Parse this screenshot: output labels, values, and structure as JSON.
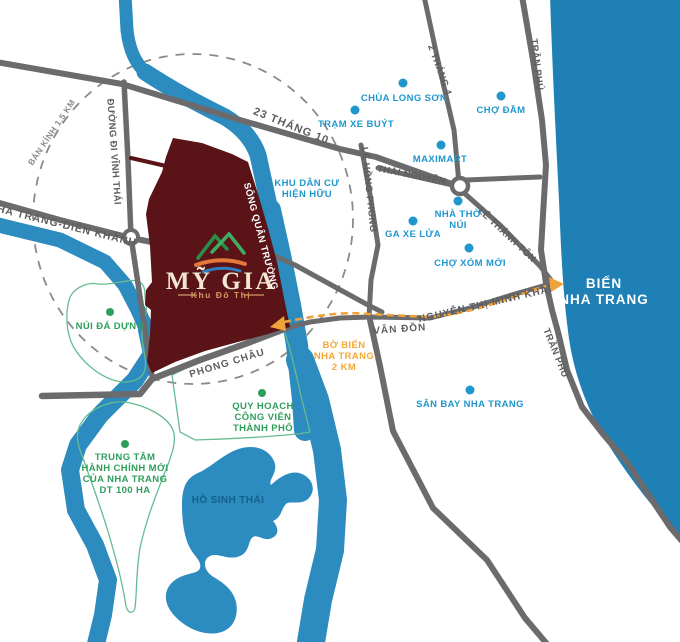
{
  "title": "Sơ đồ vị trí Khu đô thị Mỹ Gia - Nha Trang",
  "logo": {
    "title": "MỸ GIA",
    "subtitle": "Khu Đô Thị"
  },
  "radius_label": "BÁN KÍNH 1.5 KM",
  "river_label": "SÔNG QUÂN TRƯỜNG",
  "roads": {
    "r23_10": "23 THÁNG 10",
    "r2_4": "2 THÁNG 4",
    "tran_phu": "TRẦN PHÚ",
    "vinh_thai": "ĐƯỜNG ĐI VĨNH THÁI",
    "nt_dk": "NHA TRANG-DIÊN KHÁNH",
    "le_hong_phong": "LÊ HỒNG PHONG",
    "thai_nguyen": "THÁI NGUYÊN",
    "le_thanh_ton": "LÊ THÁNH TÔN",
    "ntmk": "NGUYỄN THỊ MINH KHAI",
    "van_don": "VÂN ĐỒN",
    "phong_chau": "PHONG CHÂU"
  },
  "pois": {
    "chua_long_son": "CHÙA LONG SƠN",
    "tram_xe_buyt": "TRẠM XE BUÝT",
    "cho_dam": "CHỢ ĐẦM",
    "maximart": "MAXIMART",
    "nha_tho_nui": [
      "NHÀ THỜ",
      "NÚI"
    ],
    "ga_xe_lua": "GA XE LỬA",
    "cho_xom_moi": "CHỢ XÓM MỚI",
    "san_bay": "SÂN BAY NHA TRANG",
    "khu_dan_cu": [
      "KHU DÂN CƯ",
      "HIỆN HỮU"
    ]
  },
  "areas": {
    "nui_da_dung": "NÚI ĐÁ DỰNG",
    "quy_hoach": [
      "QUY HOẠCH",
      "CÔNG VIÊN",
      "THÀNH PHỐ"
    ],
    "trung_tam": [
      "TRUNG TÂM",
      "HÀNH CHÍNH MỚI",
      "CỦA NHA TRANG",
      "DT 100 HA"
    ]
  },
  "sea": [
    "BIỂN",
    "NHA TRANG"
  ],
  "lake_label": "HỒ SINH THÁI",
  "route_note": [
    "BỜ BIỂN",
    "NHA TRANG",
    "2 KM"
  ],
  "colors": {
    "sea": "#1e80b4",
    "river": "#2c8bbf",
    "road": "#6b6b6d",
    "project_area": "#5a1418",
    "poi_blue": "#1f97cd",
    "area_green": "#2e9e5b",
    "route_orange": "#f0a23a"
  }
}
